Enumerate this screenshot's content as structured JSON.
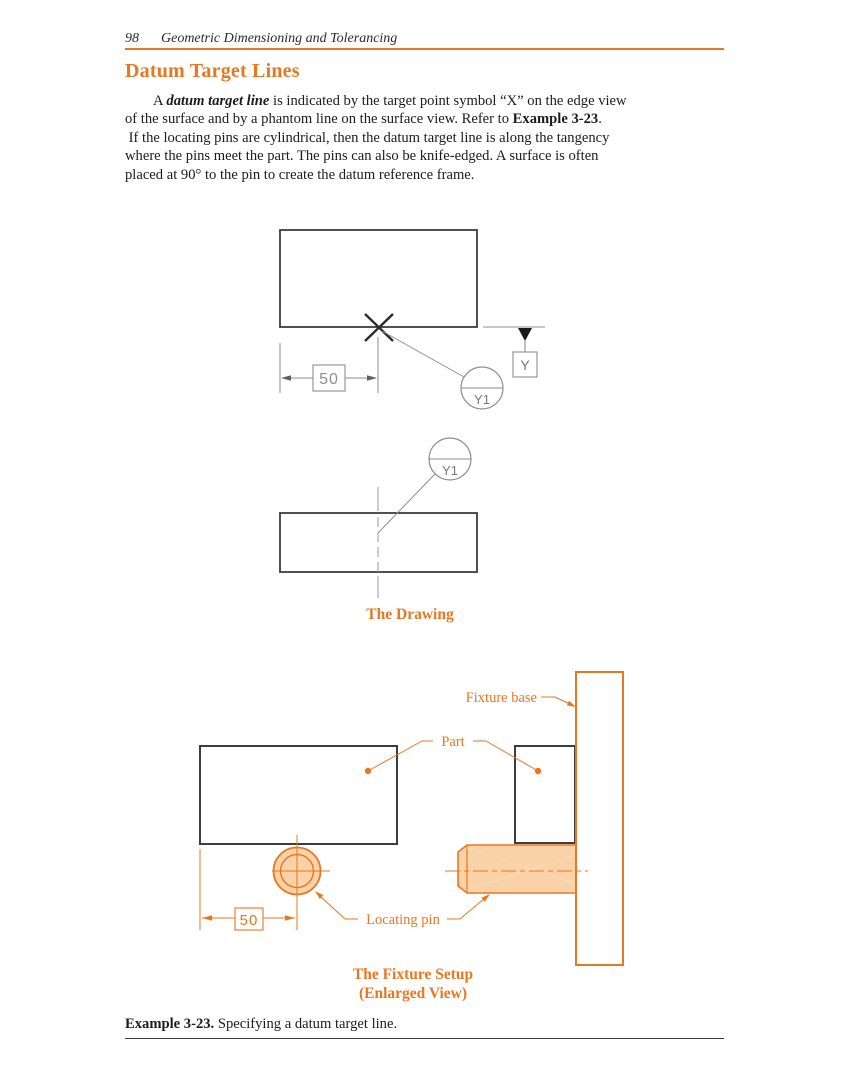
{
  "header": {
    "page_number": "98",
    "running_title": "Geometric Dimensioning and Tolerancing"
  },
  "heading": "Datum Target Lines",
  "paragraph": {
    "line1_pre": "A ",
    "line1_em": "datum target line",
    "line1_post": " is indicated by the target point symbol “X” on the edge view",
    "line2_pre": "of the surface and by a phantom line on the surface view. Refer to ",
    "line2_bold": "Example 3-23",
    "line2_post": ".",
    "line3": " If the locating pins are cylindrical, then the datum target line is along the tangency",
    "line4": "where the pins meet the part. The pins can also be knife-edged. A surface is often",
    "line5": "placed at 90° to the pin to create the datum reference frame."
  },
  "figure_drawing": {
    "caption": "The Drawing",
    "dimension": "50",
    "datum_feature_label": "Y",
    "datum_target_edge": "Y1",
    "datum_target_surface": "Y1"
  },
  "figure_fixture": {
    "caption_line1": "The Fixture Setup",
    "caption_line2": "(Enlarged View)",
    "fixture_base_label": "Fixture base",
    "part_label": "Part",
    "locating_pin_label": "Locating pin",
    "dimension": "50"
  },
  "example": {
    "bold": "Example 3-23.",
    "text": " Specifying a datum target line."
  },
  "colors": {
    "accent": "#E87722",
    "pin_fill": "#FAD2A8",
    "object_line": "#3D3D3D",
    "thin_line": "#8E8E8E"
  }
}
